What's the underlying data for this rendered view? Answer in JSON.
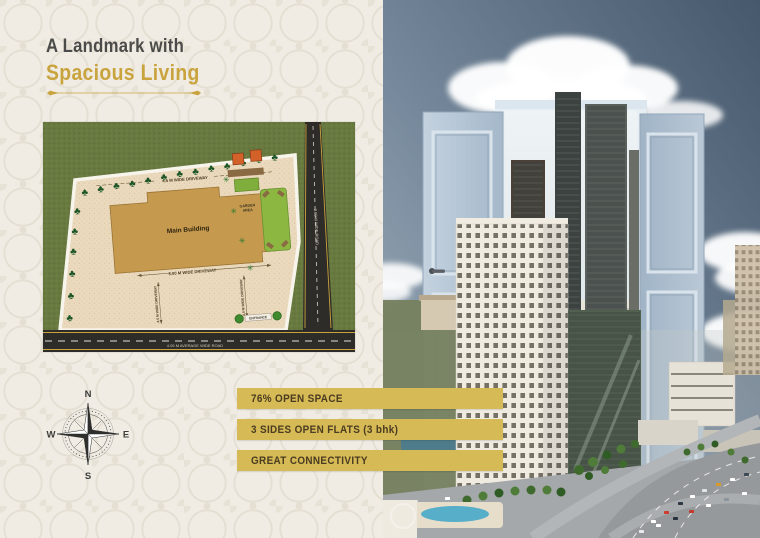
{
  "header": {
    "line1": "A Landmark with",
    "line2": "Spacious Living"
  },
  "site_plan": {
    "main_building_label": "Main Building",
    "top_driveway_label": "4.5 M WIDE DRIVEWAY",
    "inner_driveway_label": "3.00 M WIDE DRIVEWAY",
    "left_dim_label": "4.5 M WIDE DRIVEWAY",
    "right_dim_label": "4.5 M WIDE DRIVEWAY",
    "garden_area_label_1": "GARDEN",
    "garden_area_label_2": "AREA",
    "entrance_label": "ENTRANCE",
    "bottom_road_label": "4.05 M AVERAGE WIDE ROAD",
    "side_road_label": "3.60 M WIDE ROAD"
  },
  "compass": {
    "n": "N",
    "e": "E",
    "s": "S",
    "w": "W"
  },
  "features": [
    {
      "label": "76% OPEN SPACE"
    },
    {
      "label": "3 SIDES OPEN FLATS  (3 bhk)"
    },
    {
      "label": "GREAT CONNECTIVITY"
    }
  ],
  "colors": {
    "accent_gold": "#d5ba55",
    "heading_gold": "#c9a43e",
    "heading_dark": "#4b4b49",
    "banner_text": "#4a3b21",
    "grass_green": "#697a40",
    "plot_beige": "#ead9bc",
    "building_tan": "#c69a4e",
    "road_dark": "#2e2c29",
    "sky_blue": "#46586c",
    "door_blue": "#b3c3d4"
  }
}
